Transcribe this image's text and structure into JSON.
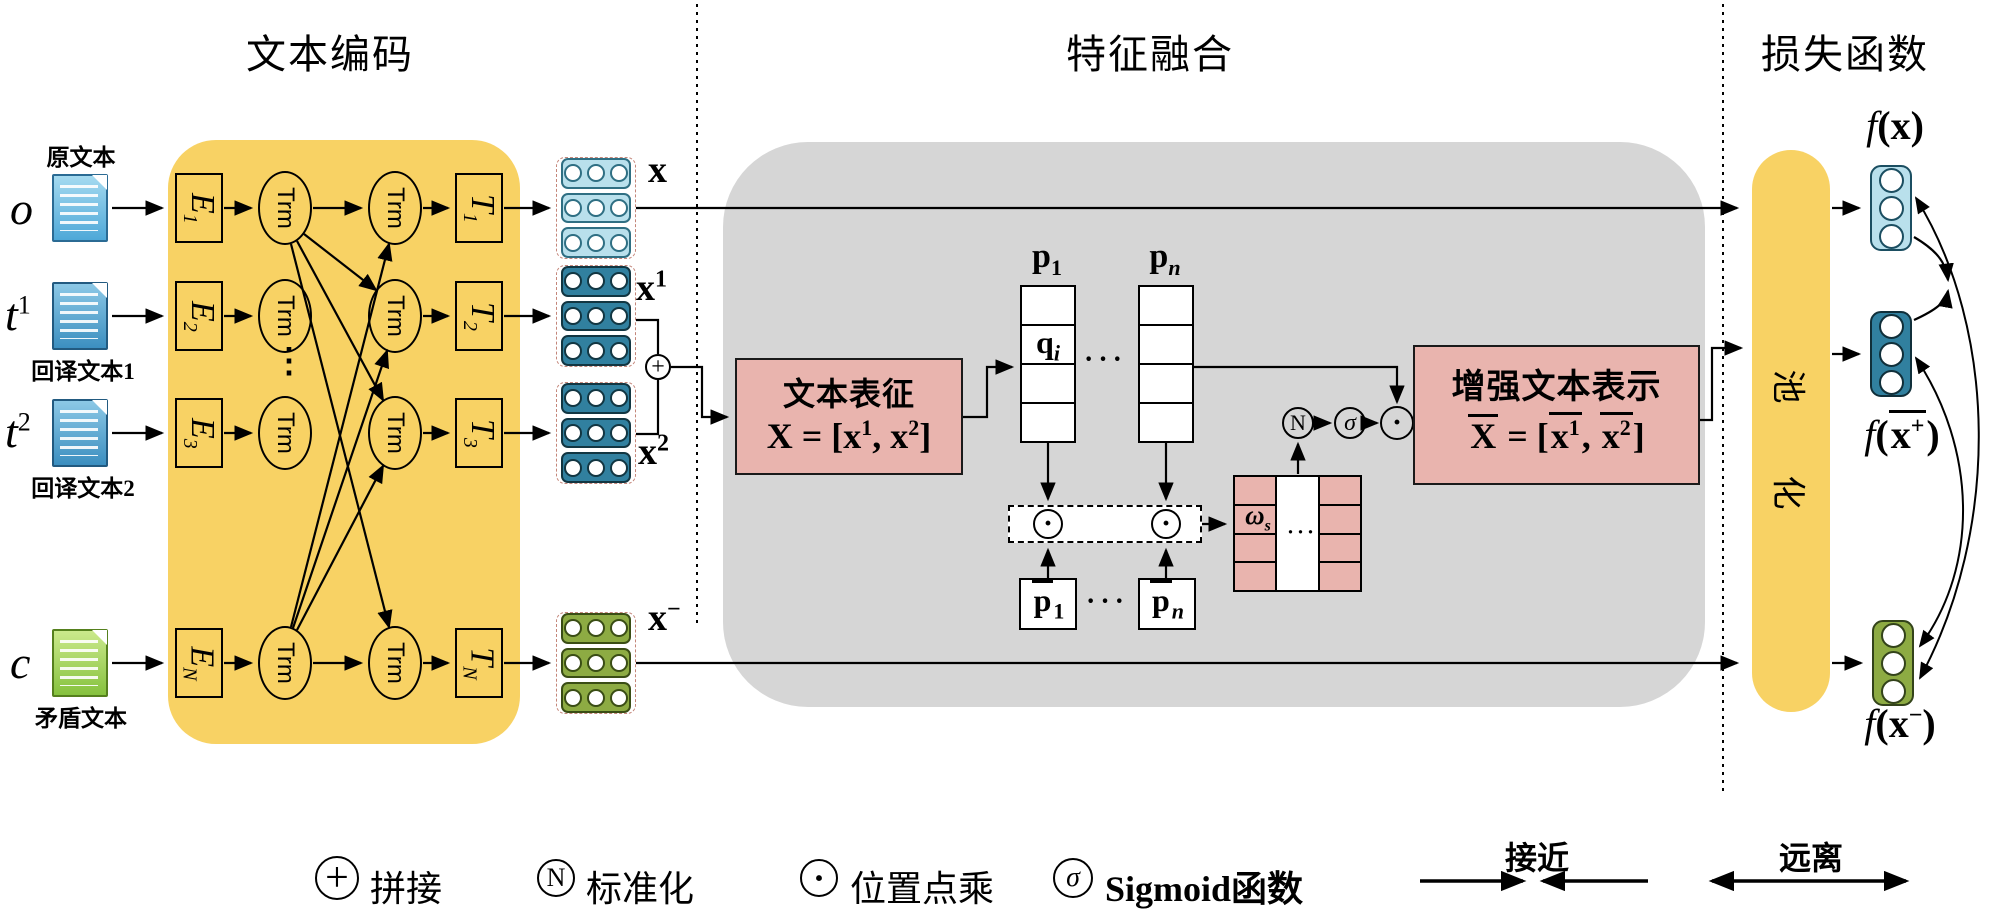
{
  "sections": {
    "encoding": "文本编码",
    "fusion": "特征融合",
    "loss": "损失函数"
  },
  "inputs": {
    "o": {
      "var": "o",
      "sup": "",
      "label": "原文本"
    },
    "t1": {
      "var": "t",
      "sup": "1",
      "label": "回译文本1"
    },
    "t2": {
      "var": "t",
      "sup": "2",
      "label": "回译文本2"
    },
    "c": {
      "var": "c",
      "sup": "",
      "label": "矛盾文本"
    }
  },
  "encoder": {
    "trm": "Trm",
    "dots": "⋮",
    "rows": [
      {
        "e": "E",
        "e_sub": "1",
        "t": "T",
        "t_sub": "1"
      },
      {
        "e": "E",
        "e_sub": "2",
        "t": "T",
        "t_sub": "2"
      },
      {
        "e": "E",
        "e_sub": "3",
        "t": "T",
        "t_sub": "3"
      },
      {
        "e": "E",
        "e_sub": "N",
        "t": "T",
        "t_sub": "N"
      }
    ]
  },
  "vectors": {
    "x": {
      "base": "x",
      "sup": ""
    },
    "x1": {
      "base": "x",
      "sup": "1"
    },
    "x2": {
      "base": "x",
      "sup": "2"
    },
    "xneg": {
      "base": "x",
      "sup": "−"
    }
  },
  "fusion": {
    "repr": {
      "title": "文本表征",
      "X": "X",
      "eq": "=",
      "open": "[",
      "x1": "x",
      "s1": "1",
      "comma": ",",
      "x2": "x",
      "s2": "2",
      "close": "]"
    },
    "enh": {
      "title": "增强文本表示",
      "X": "X",
      "eq": "=",
      "open": "[",
      "x1": "x",
      "s1": "1",
      "comma": ",",
      "x2": "x",
      "s2": "2",
      "close": "]"
    },
    "p1": {
      "base": "p",
      "sub": "1"
    },
    "pn": {
      "base": "p",
      "sub": "n"
    },
    "qi": {
      "base": "q",
      "sub": "i"
    },
    "pbar1": {
      "base": "p",
      "sub": "1"
    },
    "pbarn": {
      "base": "p",
      "sub": "n"
    },
    "omega": {
      "base": "ω",
      "sub": "s"
    },
    "hdots": "···"
  },
  "nodes": {
    "plus": "+",
    "norm": "N",
    "sigma": "σ",
    "dot": "·"
  },
  "loss": {
    "pool": [
      "池",
      "化"
    ],
    "fx": {
      "f": "f",
      "open": "(",
      "x": "x",
      "sup": "",
      "close": ")"
    },
    "fxp": {
      "f": "f",
      "open": "(",
      "x": "x",
      "sup": "+",
      "close": ")"
    },
    "fxn": {
      "f": "f",
      "open": "(",
      "x": "x",
      "sup": "−",
      "close": ")"
    }
  },
  "legend": {
    "items": [
      {
        "symbol": "+",
        "label": "拼接"
      },
      {
        "symbol": "N",
        "label": "标准化"
      },
      {
        "symbol": "·",
        "label": "位置点乘"
      },
      {
        "symbol": "σ",
        "label": "Sigmoid函数"
      }
    ],
    "relations": [
      {
        "label": "接近"
      },
      {
        "label": "远离"
      }
    ]
  },
  "colors": {
    "yellow": "#f8d264",
    "gray": "#d6d6d6",
    "pink": "#e9b4ae",
    "lightblue": "#b9e0ec",
    "lightblue-border": "#2f6f83",
    "teal": "#31809f",
    "teal-border": "#123642",
    "green": "#8dab43",
    "green-border": "#3a4d15"
  }
}
